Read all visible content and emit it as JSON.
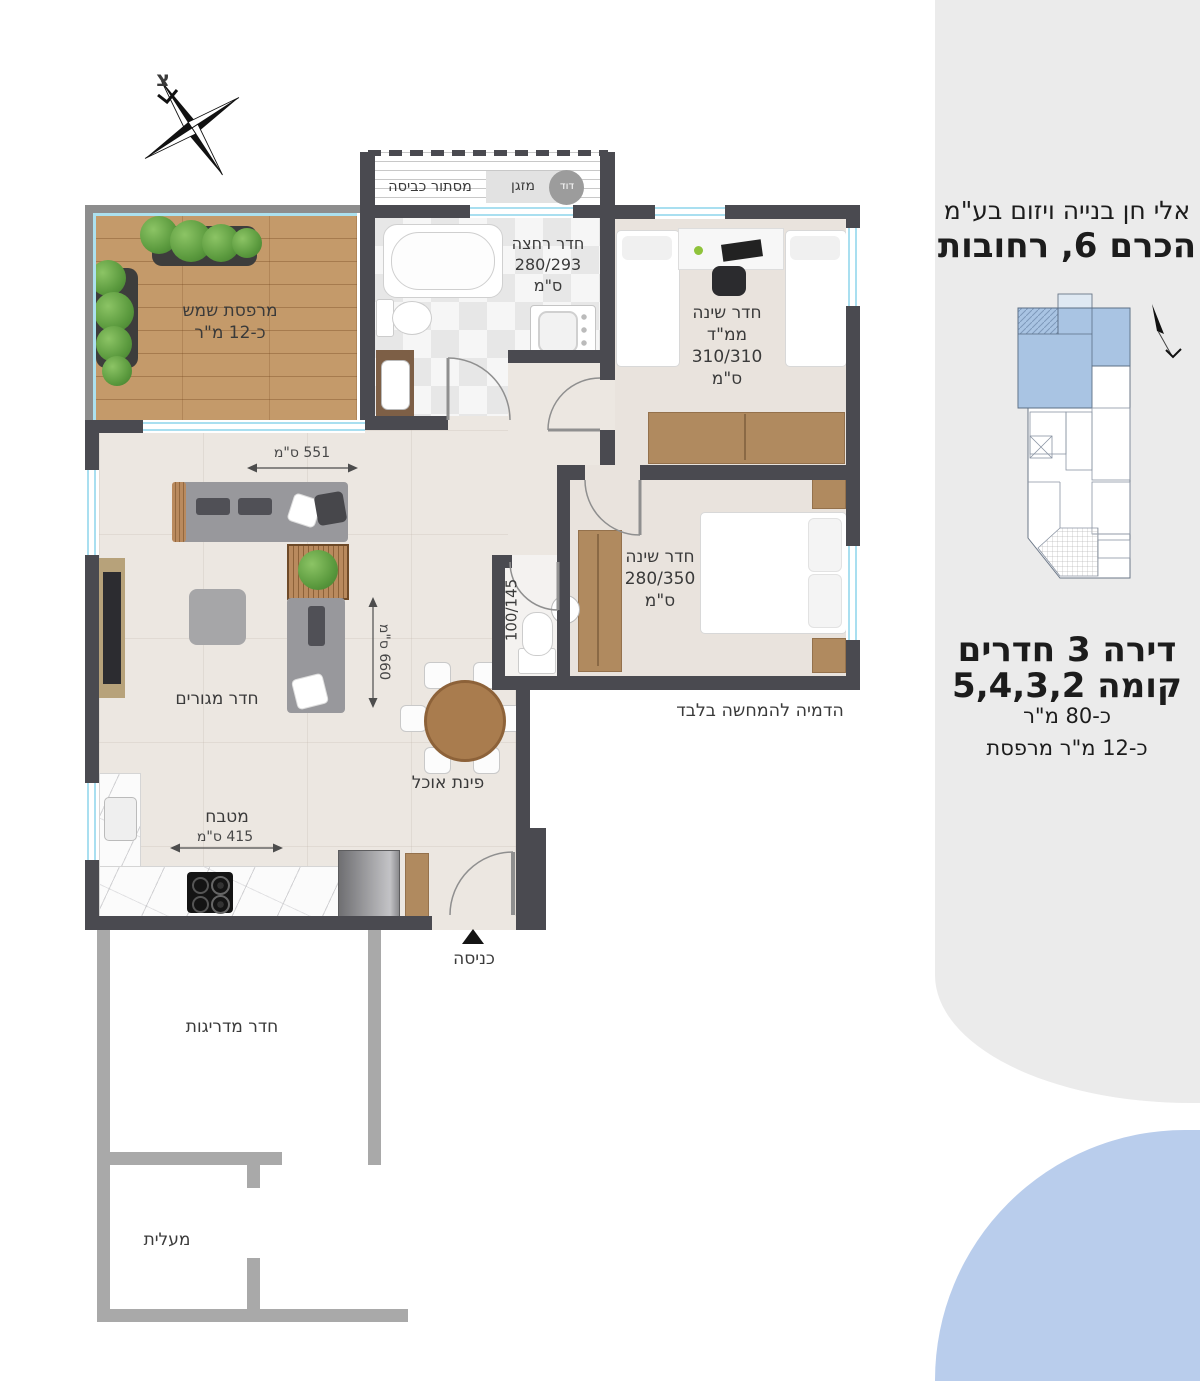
{
  "compass": {
    "north": "צ"
  },
  "plan": {
    "balcony": {
      "label": "מרפסת שמש",
      "size": "כ-12 מ\"ר"
    },
    "laundry": {
      "label": "מסתור כביסה",
      "ac": "מזגן",
      "boiler": "דוד"
    },
    "bathroom": {
      "label": "חדר רחצה",
      "dims": "280/293",
      "units": "ס\"מ"
    },
    "bedroom_mamad": {
      "label": "חדר שינה",
      "sub": "ממ\"ד",
      "dims": "310/310",
      "units": "ס\"מ"
    },
    "bedroom": {
      "label": "חדר שינה",
      "dims": "280/350",
      "units": "ס\"מ"
    },
    "toilet": {
      "dims": "100/145"
    },
    "living": {
      "label": "חדר מגורים"
    },
    "kitchen": {
      "label": "מטבח"
    },
    "dining": {
      "label": "פינת אוכל"
    },
    "entrance": {
      "label": "כניסה"
    },
    "stairwell": {
      "label": "חדר מדריגות"
    },
    "elevator": {
      "label": "מעלית"
    },
    "dim_551": "551 ס\"מ",
    "dim_660": "660 ס\"מ",
    "dim_415": "415 ס\"מ",
    "disclaimer": "הדמיה להמחשה בלבד"
  },
  "sidebar": {
    "company": "אלי חן בנייה ויזום בע\"מ",
    "address": "הכרם 6, רחובות",
    "apartment": "דירה 3 חדרים",
    "floors": "קומה 5,4,3,2",
    "area": "כ-80 מ\"ר",
    "balcony_area": "כ-12 מ\"ר מרפסת"
  },
  "colors": {
    "wall": "#4a4a50",
    "stair_wall": "#a9a9a9",
    "window": "#a9dff0",
    "wood": "#c49a6a",
    "floor": "#ece7e1",
    "sidebar_bg": "#ebebeb",
    "accent_blue": "#b9cdec",
    "keyplan_highlight": "#a9c4e3"
  }
}
